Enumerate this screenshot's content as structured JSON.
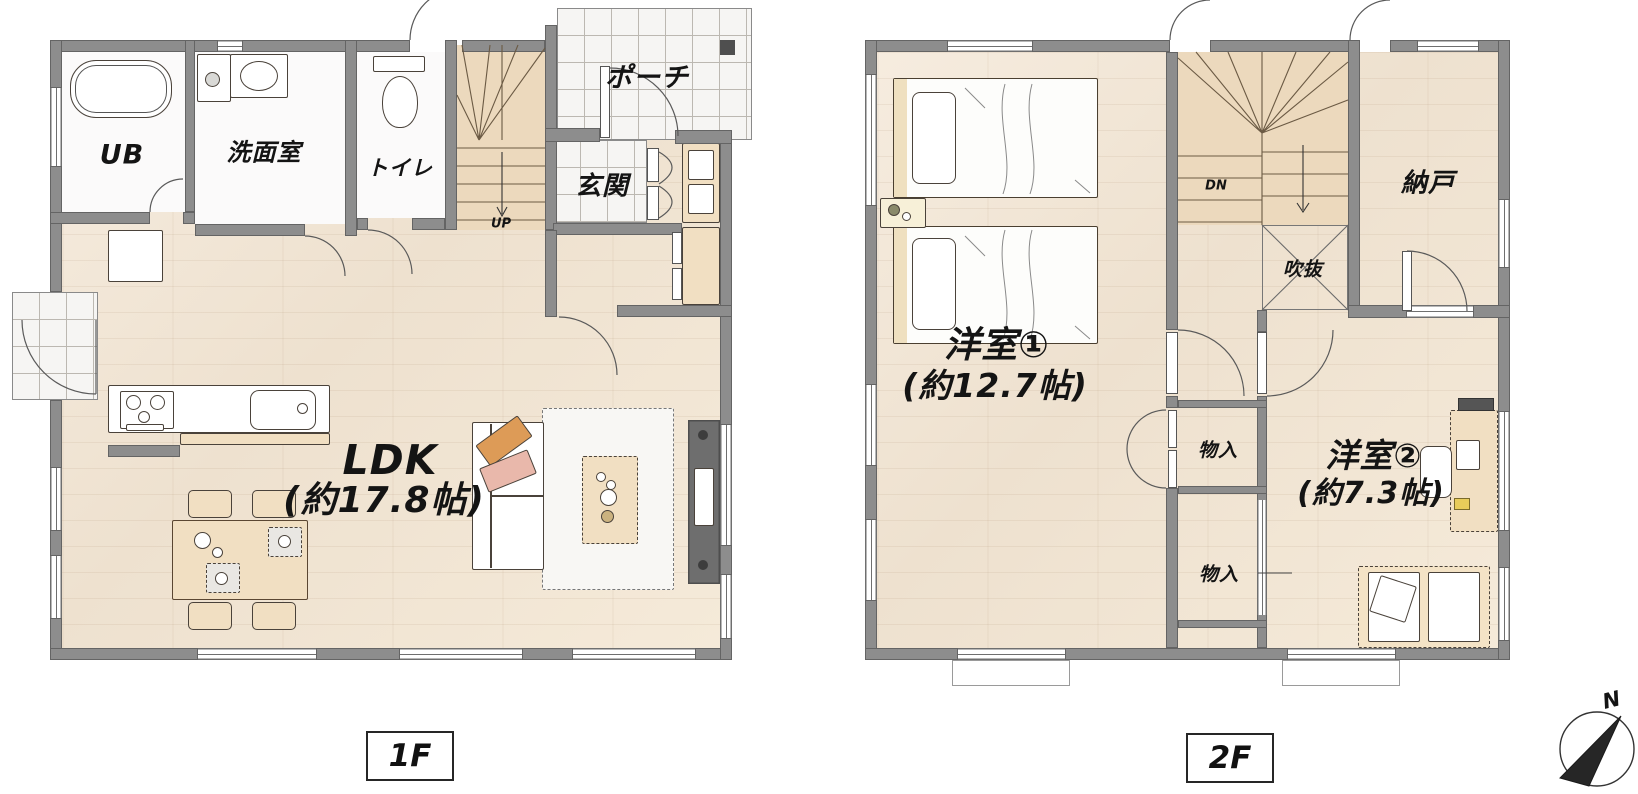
{
  "floors": [
    {
      "badge": "1F",
      "stairs_label": "UP",
      "rooms": [
        {
          "label": "UB"
        },
        {
          "label": "洗面室"
        },
        {
          "label": "トイレ"
        },
        {
          "label": "ポーチ"
        },
        {
          "label": "玄関"
        },
        {
          "label": "LDK",
          "area": "(約17.8帖)"
        }
      ]
    },
    {
      "badge": "2F",
      "stairs_label": "DN",
      "rooms": [
        {
          "label": "洋室①",
          "area": "(約12.7帖)"
        },
        {
          "label": "洋室②",
          "area": "(約7.3帖)"
        },
        {
          "label": "納戸"
        },
        {
          "label": "吹抜"
        },
        {
          "label": "物入"
        },
        {
          "label": "物入"
        }
      ]
    }
  ],
  "compass": {
    "label": "N"
  },
  "colors": {
    "wall": "#8d8d8d",
    "wood_floor": "#f3e8da",
    "tile_floor": "#f6f5f3",
    "stair_floor": "#ecd9bd",
    "cushion_orange": "#dd9b57",
    "cushion_pink": "#e9b8ab",
    "tv_board": "#6e6e6e"
  }
}
